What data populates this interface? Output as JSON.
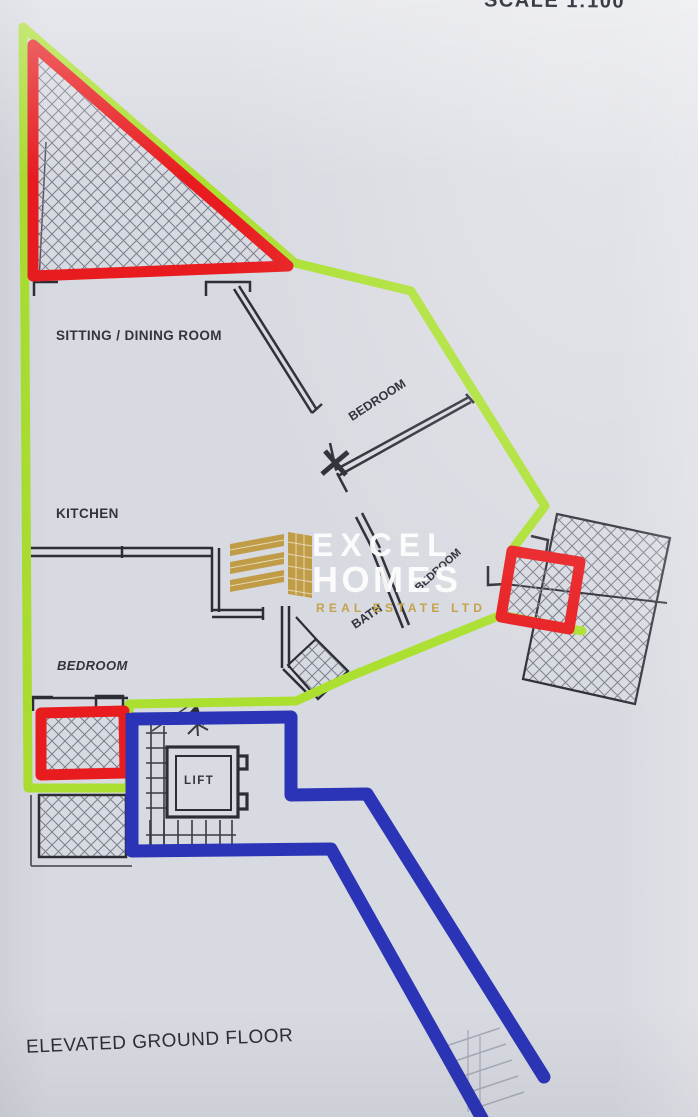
{
  "page": {
    "scale_label": "SCALE 1:100",
    "floor_label": "ELEVATED GROUND FLOOR"
  },
  "rooms": {
    "sitting_dining": "SITTING / DINING ROOM",
    "kitchen": "KITCHEN",
    "bedroom_top": "BEDROOM",
    "bedroom_mid": "BEDROOM",
    "bedroom_left": "BEDROOM",
    "bath": "BATH",
    "lift": "LIFT"
  },
  "watermark": {
    "line1": "EXCEL",
    "line2": "HOMES",
    "line3": "REAL ESTATE LTD",
    "gold": "#c5a14b"
  },
  "colors": {
    "boundary_green": "#abe030",
    "highlight_red": "#e81c1f",
    "route_blue": "#2b34b6",
    "walls": "#2d2d36",
    "paper": "#d8dae1"
  }
}
